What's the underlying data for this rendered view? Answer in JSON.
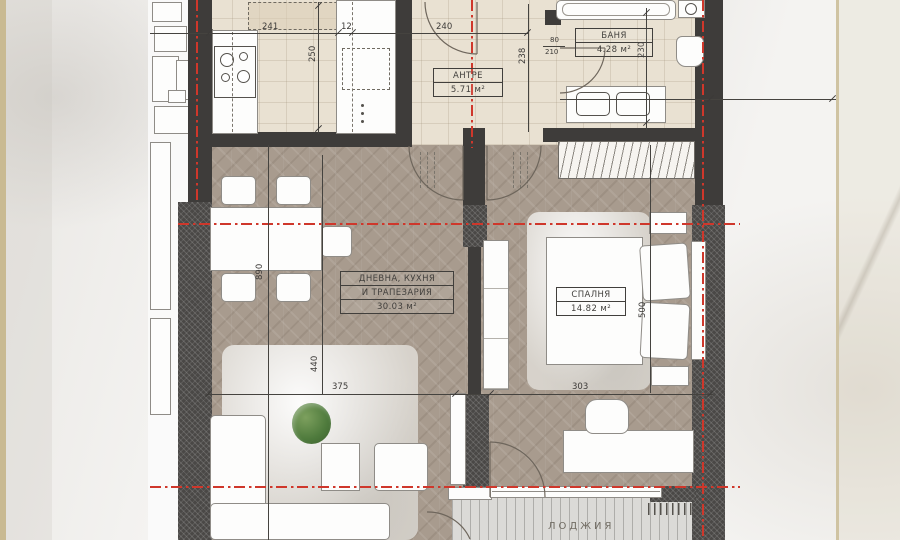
{
  "rooms": {
    "antre": {
      "name": "АНТРЕ",
      "area": "5.71 м²"
    },
    "banya": {
      "name": "БАНЯ",
      "area": "4.28 м²"
    },
    "living": {
      "line1": "ДНЕВНА, КУХНЯ",
      "line2": "И ТРАПЕЗАРИЯ",
      "area": "30.03 м²"
    },
    "bedroom": {
      "name": "СПАЛНЯ",
      "area": "14.82 м²"
    },
    "loggia": {
      "name": "ЛОДЖИЯ"
    }
  },
  "dims": {
    "d241": "241",
    "d12": "12",
    "d240": "240",
    "d250": "250",
    "d238": "238",
    "d80": "80",
    "d210": "210",
    "d230": "230",
    "d890": "890",
    "d440": "440",
    "d375": "375",
    "d303": "303",
    "d500": "500"
  },
  "colors": {
    "wall": "#3e3c3a",
    "axis_red": "#cf372b",
    "tile_floor": "#e9e1d2",
    "wood_floor": "#a89b8e",
    "deck": "#dbdad7",
    "marble": "#f4f3f1",
    "edge_stripe": "#c9ba92"
  }
}
